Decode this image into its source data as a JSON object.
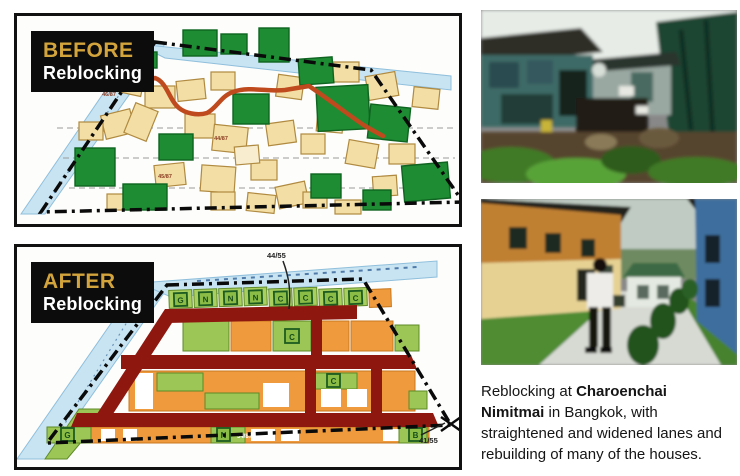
{
  "before_panel": {
    "label_line1": "BEFORE",
    "label_line2": "Reblocking",
    "plot_labels": [
      "46/87",
      "44/87",
      "45/87"
    ]
  },
  "after_panel": {
    "label_line1": "AFTER",
    "label_line2": "Reblocking",
    "label_top": "44/55",
    "label_corner": "41/55",
    "plot_label": "34/87",
    "letters": [
      "G",
      "N",
      "N",
      "N",
      "C",
      "C",
      "C",
      "C"
    ],
    "scatter": [
      "C",
      "C",
      "G",
      "N",
      "B"
    ]
  },
  "caption": {
    "lines": [
      {
        "pre": "Reblocking at ",
        "bold": "Charoenchai",
        "post": ""
      },
      {
        "pre": "",
        "bold": "Nimitmai",
        "post": " in Bangkok, with"
      },
      {
        "pre": "straightened and widened lanes and",
        "bold": "",
        "post": ""
      },
      {
        "pre": "rebuilding of many of the houses.",
        "bold": "",
        "post": ""
      }
    ]
  },
  "colors": {
    "label_gold": "#d4a43c",
    "lane_before": "#bf4a1e",
    "lane_after": "#8e1810",
    "canal_blue": "#c8e4f2",
    "plot_orange": "#ef9a3c",
    "plot_green": "#9cc655",
    "building_green": "#1d8c33",
    "building_tan": "#f3dfa5"
  }
}
